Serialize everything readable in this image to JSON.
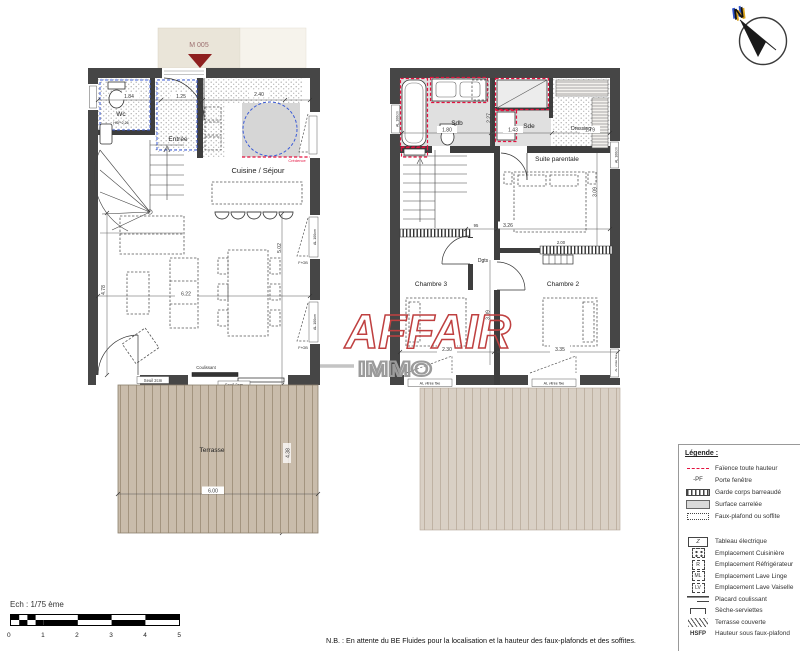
{
  "north": {
    "letter": "N"
  },
  "entry_marker": {
    "label": "M 005"
  },
  "watermark": {
    "primary": "AFFAIR",
    "secondary": "IMMO"
  },
  "ground_floor": {
    "rooms": {
      "wc": "Wc",
      "wc_height": "HSP 2,26",
      "entree": "Entrée",
      "cuisine_sejour": "Cuisine / Séjour",
      "terrasse": "Terrasse"
    },
    "dims": {
      "top_left": "1.84",
      "top_mid": "1.25",
      "top_right": "2.40",
      "width": "6.22",
      "left_height": "4.78",
      "right_height": "5.02",
      "terrasse_width": "6.00",
      "terrasse_height": "4.38"
    },
    "annotations": {
      "credence": "Crédence",
      "sliding_door": "Coulissant",
      "threshold_left": "Seuil 2cm",
      "threshold_center": "Seuil 2cm",
      "window_right_top": "AL 100cm",
      "window_right_bottom": "AL 100cm",
      "fob_top": "F+OB",
      "fob_bottom": "F+OB"
    }
  },
  "upper_floor": {
    "rooms": {
      "sdb": "Sdb",
      "sde": "Sde",
      "dressing": "Dressing",
      "suite": "Suite parentale",
      "chambre2": "Chambre 2",
      "chambre3": "Chambre 3",
      "degagement": "Dgts"
    },
    "dims": {
      "sdb_width": "1.80",
      "sdb_depth": "2.27",
      "sde_width": "1.43",
      "dressing_width": "1.79",
      "suite_depth": "3.09",
      "suite_width": "3.26",
      "hall": "95",
      "garde_corps": "2.00",
      "chambre3_width": "2.30",
      "chambre2_width": "3.35",
      "chambre_depth": "3.09"
    },
    "annotations": {
      "window_left": "AL 100cm",
      "window_right_top": "AL 100cm",
      "window_right_bottom": "AL vitrée fixe",
      "window_bottom_left": "AL vitrée fixe",
      "window_bottom_right": "AL vitrée fixe"
    }
  },
  "legend": {
    "title": "Légende :",
    "group1": [
      {
        "symbol": "faience-dash",
        "label": "Faïence toute hauteur"
      },
      {
        "symbol": "porte-fenetre",
        "symbol_text": "-PF",
        "label": "Porte fenêtre"
      },
      {
        "symbol": "garde-corps",
        "label": "Garde corps barreaudé"
      },
      {
        "symbol": "surface-carrelee",
        "label": "Surface carrelée"
      },
      {
        "symbol": "faux-plafond",
        "label": "Faux-plafond ou soffite"
      }
    ],
    "group2": [
      {
        "symbol": "tableau-electrique",
        "symbol_text": "Z",
        "label": "Tableau électrique"
      },
      {
        "symbol": "cuisiniere",
        "label": "Emplacement Cuisinière"
      },
      {
        "symbol": "refrigerateur",
        "symbol_text": "R",
        "label": "Emplacement Réfrigérateur"
      },
      {
        "symbol": "lave-linge",
        "symbol_text": "ML",
        "label": "Emplacement Lave Linge"
      },
      {
        "symbol": "lave-vaisselle",
        "symbol_text": "LV",
        "label": "Emplacement Lave Vaiselle"
      },
      {
        "symbol": "placard-coulissant",
        "label": "Placard coulissant"
      },
      {
        "symbol": "seche-serviettes",
        "label": "Sèche-serviettes"
      },
      {
        "symbol": "terrasse-couverte",
        "label": "Terrasse couverte"
      },
      {
        "symbol": "hsfp",
        "symbol_text": "HSFP",
        "label": "Hauteur sous faux-plafond"
      }
    ]
  },
  "scale_bar": {
    "label": "Ech : 1/75 ème",
    "ticks": [
      "0",
      "1",
      "2",
      "3",
      "4",
      "5"
    ]
  },
  "note": "N.B. : En attente du BE Fluides pour la localisation et la hauteur des faux-plafonds et des soffites.",
  "colors": {
    "wall": "#464646",
    "faience_red": "#e4123f",
    "soffit_blue": "#3b5bd6",
    "terrasse": "#c9bcab",
    "terrasse_couverte": "#d9d0c5",
    "watermark_red": "#bf4040"
  }
}
